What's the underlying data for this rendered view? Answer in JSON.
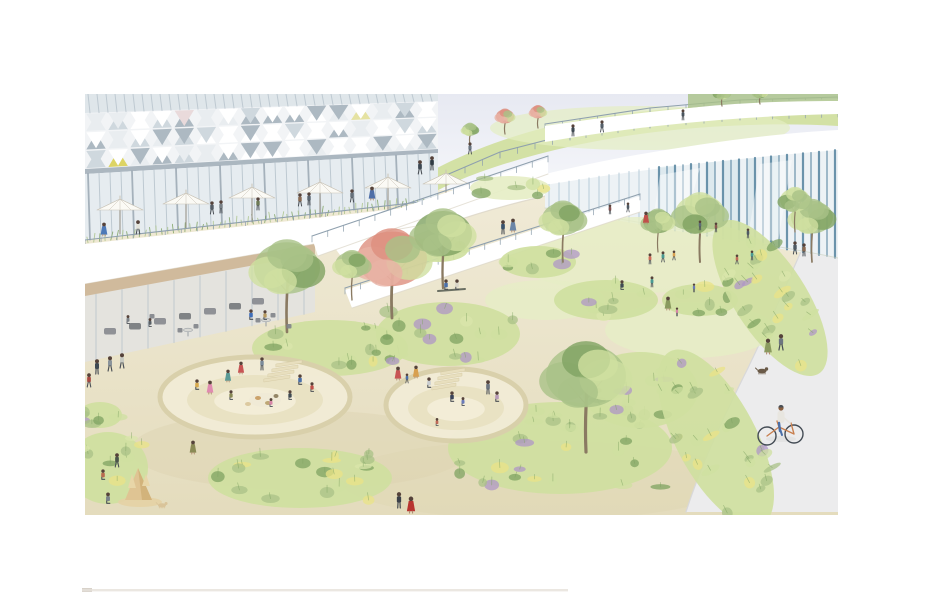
{
  "scene": {
    "type": "watercolor architectural perspective rendering",
    "subject": "landscaped plaza park with sunken seating pits, terraced buildings with green roofs, glass pavilions, planting beds and a promenade with a cyclist",
    "visible_text": "none",
    "artwork_bounds": {
      "x": 85,
      "y": 94,
      "width": 753,
      "height": 421
    }
  },
  "palette": {
    "paper": "#ffffff",
    "sky": "#e7e9f2",
    "skyFade": "#fafbfd",
    "ground": "#f0ead6",
    "groundDeep": "#e4dcbd",
    "groundShade": "#ddd3b0",
    "path": "#ececed",
    "pathEdge": "#d8d8da",
    "lawn": "#d9e5ab",
    "lawnLight": "#e6eec6",
    "hill": "#d3e1a5",
    "hillLight": "#e4eec2",
    "canopy": "#ffffff",
    "canopyShadow": "#dcd6c8",
    "glass": "#edf2f5",
    "glassTint": "#dfe6ea",
    "mullion": "#b7c3cc",
    "mullionDark": "#9aa7b2",
    "teal": "#5d89a3",
    "tealLight": "#b3c8d6",
    "tealPanel": "#cfe2e8",
    "triDark": "#adb9c2",
    "triMid": "#cfd8de",
    "triLight": "#e9edf0",
    "triYellow": "#ddd464",
    "triYellow2": "#e5e2a2",
    "triPink": "#e9dadb",
    "slab": "#ffffff",
    "wood": "#cdb391",
    "interior": "#e8e4da",
    "seat": "#80838a",
    "grassLight": "#cfe0a0",
    "grassMid": "#a9c287",
    "grassDark": "#7fa362",
    "accentYellow": "#e9e387",
    "accentPurple": "#af97c5",
    "blossom": "#dd8f7e",
    "blossomLight": "#e8b3a5",
    "trunk": "#8a7a62",
    "rail": "#8fa0ae",
    "pitFloor": "#f2ecd6",
    "pitInner": "#e8e0c0",
    "pitRim": "#d9d0ab",
    "sand": "#dfc493",
    "sandShade": "#c9a86a",
    "skin": "#b08b6e",
    "hair": "#55423a",
    "umbrella": "#fbfaf5",
    "umbrellaRib": "#c9c3b6",
    "pageLine": "#e6e1da"
  },
  "umbrellas": [
    {
      "x": 120,
      "y": 210
    },
    {
      "x": 186,
      "y": 204
    },
    {
      "x": 252,
      "y": 198
    },
    {
      "x": 320,
      "y": 193
    },
    {
      "x": 388,
      "y": 188
    },
    {
      "x": 446,
      "y": 184
    }
  ],
  "railings": [
    {
      "name": "hill-rail",
      "z": "back",
      "pts": [
        [
          430,
          182
        ],
        [
          500,
          152
        ],
        [
          570,
          134
        ],
        [
          650,
          122
        ],
        [
          740,
          114
        ],
        [
          838,
          111
        ]
      ],
      "post": 6
    },
    {
      "name": "roof-edge-rail",
      "z": "back",
      "pts": [
        [
          545,
          124
        ],
        [
          650,
          108
        ],
        [
          740,
          100
        ],
        [
          838,
          97
        ]
      ],
      "post": 4
    },
    {
      "name": "terrace-rail",
      "z": "mid",
      "pts": [
        [
          85,
          240
        ],
        [
          438,
          200
        ]
      ],
      "post": 5
    },
    {
      "name": "ramp-upper-rail",
      "z": "front",
      "pts": [
        [
          312,
          236
        ],
        [
          548,
          156
        ]
      ],
      "post": 6
    },
    {
      "name": "ramp-lower-rail",
      "z": "front",
      "pts": [
        [
          345,
          288
        ],
        [
          640,
          194
        ]
      ],
      "post": 6
    }
  ],
  "beds": [
    {
      "x": 330,
      "y": 348,
      "rx": 78,
      "ry": 28
    },
    {
      "x": 448,
      "y": 334,
      "rx": 72,
      "ry": 32,
      "pu": 1
    },
    {
      "x": 300,
      "y": 478,
      "rx": 92,
      "ry": 30,
      "ye": 1
    },
    {
      "x": 108,
      "y": 468,
      "rx": 40,
      "ry": 36,
      "ye": 1
    },
    {
      "x": 560,
      "y": 448,
      "rx": 112,
      "ry": 46,
      "ye": 1,
      "pu": 1
    },
    {
      "x": 640,
      "y": 390,
      "rx": 58,
      "ry": 38,
      "pu": 1
    },
    {
      "x": 606,
      "y": 300,
      "rx": 52,
      "ry": 20
    },
    {
      "x": 700,
      "y": 300,
      "rx": 38,
      "ry": 16
    },
    {
      "x": 538,
      "y": 262,
      "rx": 38,
      "ry": 16
    },
    {
      "x": 770,
      "y": 298,
      "rx": 36,
      "ry": 90,
      "rot": -33,
      "ye": 1,
      "pu": 1
    },
    {
      "x": 716,
      "y": 438,
      "rx": 40,
      "ry": 98,
      "rot": -28,
      "ye": 1,
      "pu": 1
    },
    {
      "x": 100,
      "y": 415,
      "rx": 22,
      "ry": 13
    },
    {
      "x": 438,
      "y": 250,
      "rx": 30,
      "ry": 12
    },
    {
      "x": 510,
      "y": 188,
      "rx": 40,
      "ry": 12,
      "light": 1
    }
  ],
  "lawnPatches": [
    {
      "x": 640,
      "y": 255,
      "rx": 130,
      "ry": 38
    },
    {
      "x": 545,
      "y": 300,
      "rx": 60,
      "ry": 20
    },
    {
      "x": 690,
      "y": 330,
      "rx": 85,
      "ry": 28
    }
  ],
  "trees": [
    {
      "x": 287,
      "y": 332,
      "h": 80,
      "r": 33,
      "t": "g"
    },
    {
      "x": 392,
      "y": 318,
      "h": 74,
      "r": 35,
      "t": "b"
    },
    {
      "x": 443,
      "y": 288,
      "h": 68,
      "r": 29,
      "t": "g"
    },
    {
      "x": 563,
      "y": 262,
      "h": 54,
      "r": 21,
      "t": "g"
    },
    {
      "x": 700,
      "y": 262,
      "h": 60,
      "r": 25,
      "t": "g"
    },
    {
      "x": 586,
      "y": 452,
      "h": 95,
      "r": 40,
      "t": "g"
    },
    {
      "x": 812,
      "y": 262,
      "h": 56,
      "r": 21,
      "t": "g"
    },
    {
      "x": 795,
      "y": 232,
      "h": 40,
      "r": 15,
      "t": "g"
    },
    {
      "x": 658,
      "y": 252,
      "h": 38,
      "r": 15,
      "t": "g"
    },
    {
      "x": 352,
      "y": 300,
      "h": 44,
      "r": 17,
      "t": "g"
    },
    {
      "x": 505,
      "y": 134,
      "h": 22,
      "r": 9,
      "t": "b"
    },
    {
      "x": 538,
      "y": 128,
      "h": 20,
      "r": 8,
      "t": "b"
    },
    {
      "x": 470,
      "y": 144,
      "h": 18,
      "r": 8,
      "t": "g"
    },
    {
      "x": 722,
      "y": 106,
      "h": 16,
      "r": 8,
      "t": "g"
    },
    {
      "x": 760,
      "y": 104,
      "h": 14,
      "r": 7,
      "t": "g"
    }
  ],
  "pits": [
    {
      "cx": 255,
      "cy": 397,
      "rx": 95,
      "ry": 40,
      "irx": 68,
      "iry": 25,
      "steps": {
        "x": 276,
        "y": 364,
        "n": 4,
        "w": 26,
        "dx": -4,
        "dy": 5
      }
    },
    {
      "cx": 456,
      "cy": 405,
      "rx": 70,
      "ry": 36,
      "irx": 48,
      "iry": 22,
      "steps": {
        "x": 441,
        "y": 372,
        "n": 4,
        "w": 24,
        "dx": -3,
        "dy": 5
      }
    }
  ],
  "picnic": [
    {
      "x": 265,
      "y": 400,
      "rx": 16,
      "ry": 7,
      "c": "#efe9d6"
    },
    {
      "x": 258,
      "y": 398,
      "rx": 3,
      "ry": 2,
      "c": "#c69a5e"
    },
    {
      "x": 268,
      "y": 403,
      "rx": 3,
      "ry": 2,
      "c": "#b8a06a"
    },
    {
      "x": 276,
      "y": 396,
      "rx": 2.5,
      "ry": 2,
      "c": "#8a7a5a"
    },
    {
      "x": 248,
      "y": 404,
      "rx": 3,
      "ry": 2,
      "c": "#d9c49a"
    }
  ],
  "sandcastle": {
    "x": 138,
    "y": 500
  },
  "furniture": {
    "tables": [
      {
        "x": 266,
        "y": 320
      },
      {
        "x": 188,
        "y": 330
      }
    ],
    "chairs": [
      {
        "x": 258,
        "y": 322
      },
      {
        "x": 273,
        "y": 317
      },
      {
        "x": 289,
        "y": 328
      },
      {
        "x": 180,
        "y": 332
      },
      {
        "x": 196,
        "y": 328
      },
      {
        "x": 152,
        "y": 318
      }
    ],
    "bench": {
      "x1": 438,
      "y1": 291,
      "x2": 465,
      "y2": 289
    },
    "interiorSeats": [
      {
        "x": 110,
        "y": 332
      },
      {
        "x": 135,
        "y": 327
      },
      {
        "x": 160,
        "y": 322
      },
      {
        "x": 185,
        "y": 317
      },
      {
        "x": 210,
        "y": 312
      },
      {
        "x": 235,
        "y": 307
      },
      {
        "x": 258,
        "y": 302
      }
    ]
  },
  "people": [
    {
      "x": 104,
      "y": 236,
      "h": 13,
      "c": "#4d79b8",
      "d": 1
    },
    {
      "x": 138,
      "y": 234,
      "h": 13,
      "c": "#e3e3da"
    },
    {
      "x": 212,
      "y": 214,
      "h": 12,
      "c": "#555d66"
    },
    {
      "x": 221,
      "y": 213,
      "h": 12,
      "c": "#7a8288"
    },
    {
      "x": 258,
      "y": 210,
      "h": 12,
      "c": "#6d7a55"
    },
    {
      "x": 300,
      "y": 206,
      "h": 12,
      "c": "#8a6a52"
    },
    {
      "x": 309,
      "y": 205,
      "h": 12,
      "c": "#5a6570"
    },
    {
      "x": 352,
      "y": 202,
      "h": 12,
      "c": "#66707a"
    },
    {
      "x": 573,
      "y": 136,
      "h": 11,
      "c": "#3f4a52"
    },
    {
      "x": 602,
      "y": 132,
      "h": 11,
      "c": "#55606a"
    },
    {
      "x": 683,
      "y": 120,
      "h": 10,
      "c": "#4a555e"
    },
    {
      "x": 470,
      "y": 154,
      "h": 11,
      "c": "#6a7580"
    },
    {
      "x": 420,
      "y": 174,
      "h": 13,
      "c": "#3d4852"
    },
    {
      "x": 432,
      "y": 170,
      "h": 13,
      "c": "#2f3a44"
    },
    {
      "x": 372,
      "y": 200,
      "h": 13,
      "c": "#4f6fa8",
      "d": 1
    },
    {
      "x": 503,
      "y": 234,
      "h": 13,
      "c": "#39536e"
    },
    {
      "x": 513,
      "y": 232,
      "h": 13,
      "c": "#6b86a8",
      "d": 1
    },
    {
      "x": 610,
      "y": 214,
      "h": 9,
      "c": "#84504e"
    },
    {
      "x": 628,
      "y": 212,
      "h": 9,
      "c": "#4f5a64"
    },
    {
      "x": 700,
      "y": 230,
      "h": 9,
      "c": "#5d6a74"
    },
    {
      "x": 716,
      "y": 232,
      "h": 9,
      "c": "#8a5a50"
    },
    {
      "x": 748,
      "y": 238,
      "h": 9,
      "c": "#4f5a64"
    },
    {
      "x": 646,
      "y": 224,
      "h": 12,
      "c": "#c0504a",
      "d": 1
    },
    {
      "x": 650,
      "y": 264,
      "h": 10,
      "c": "#cf6a58"
    },
    {
      "x": 663,
      "y": 262,
      "h": 10,
      "c": "#4a9a94"
    },
    {
      "x": 674,
      "y": 260,
      "h": 9,
      "c": "#d8a050"
    },
    {
      "x": 622,
      "y": 290,
      "h": 11,
      "c": "#3f4a52",
      "p": 1
    },
    {
      "x": 652,
      "y": 287,
      "h": 10,
      "c": "#4a9a94"
    },
    {
      "x": 668,
      "y": 310,
      "h": 13,
      "c": "#8a9a5f",
      "d": 1
    },
    {
      "x": 677,
      "y": 316,
      "h": 8,
      "c": "#d885a8"
    },
    {
      "x": 694,
      "y": 292,
      "h": 8,
      "c": "#6a7ab8"
    },
    {
      "x": 446,
      "y": 290,
      "h": 12,
      "c": "#4a6fa8",
      "p": 1
    },
    {
      "x": 457,
      "y": 290,
      "h": 12,
      "c": "#d8d4c8",
      "p": 1
    },
    {
      "x": 251,
      "y": 320,
      "h": 12,
      "c": "#3f6db8",
      "p": 1
    },
    {
      "x": 265,
      "y": 320,
      "h": 11,
      "c": "#b89a60",
      "p": 1
    },
    {
      "x": 150,
      "y": 327,
      "h": 10,
      "c": "#596066",
      "p": 1
    },
    {
      "x": 128,
      "y": 324,
      "h": 10,
      "c": "#7b8187",
      "p": 1
    },
    {
      "x": 97,
      "y": 374,
      "h": 14,
      "c": "#3f4a52"
    },
    {
      "x": 110,
      "y": 371,
      "h": 14,
      "c": "#8a939b"
    },
    {
      "x": 122,
      "y": 368,
      "h": 14,
      "c": "#c8cac2"
    },
    {
      "x": 89,
      "y": 387,
      "h": 13,
      "c": "#a84a42"
    },
    {
      "x": 210,
      "y": 394,
      "h": 13,
      "c": "#e08bb0",
      "d": 1
    },
    {
      "x": 197,
      "y": 390,
      "h": 12,
      "c": "#d7a94e",
      "p": 1
    },
    {
      "x": 228,
      "y": 382,
      "h": 12,
      "c": "#5a9a96",
      "d": 1
    },
    {
      "x": 241,
      "y": 374,
      "h": 12,
      "c": "#c85454",
      "d": 1
    },
    {
      "x": 262,
      "y": 370,
      "h": 12,
      "c": "#7a8a9a"
    },
    {
      "x": 300,
      "y": 385,
      "h": 12,
      "c": "#4a6fa8",
      "p": 1
    },
    {
      "x": 312,
      "y": 392,
      "h": 11,
      "c": "#c0504a",
      "p": 1
    },
    {
      "x": 290,
      "y": 400,
      "h": 11,
      "c": "#3f4a52",
      "p": 1
    },
    {
      "x": 271,
      "y": 407,
      "h": 10,
      "c": "#d885a8",
      "p": 1
    },
    {
      "x": 231,
      "y": 400,
      "h": 11,
      "c": "#8a8a55",
      "p": 1
    },
    {
      "x": 193,
      "y": 454,
      "h": 13,
      "c": "#8a8a55",
      "d": 1
    },
    {
      "x": 117,
      "y": 467,
      "h": 13,
      "c": "#4a554a"
    },
    {
      "x": 103,
      "y": 480,
      "h": 12,
      "c": "#b86a50",
      "p": 1
    },
    {
      "x": 108,
      "y": 504,
      "h": 13,
      "c": "#7a8288",
      "p": 1
    },
    {
      "x": 398,
      "y": 380,
      "h": 13,
      "c": "#c85454",
      "d": 1
    },
    {
      "x": 407,
      "y": 383,
      "h": 9,
      "c": "#4a6fa8"
    },
    {
      "x": 416,
      "y": 378,
      "h": 12,
      "c": "#d8a050",
      "d": 1
    },
    {
      "x": 429,
      "y": 388,
      "h": 12,
      "c": "#c8ccd0",
      "p": 1
    },
    {
      "x": 452,
      "y": 402,
      "h": 12,
      "c": "#39435a",
      "p": 1
    },
    {
      "x": 463,
      "y": 406,
      "h": 10,
      "c": "#6a7ab8",
      "p": 1
    },
    {
      "x": 488,
      "y": 394,
      "h": 13,
      "c": "#6d7580"
    },
    {
      "x": 497,
      "y": 402,
      "h": 12,
      "c": "#b89ab8",
      "p": 1
    },
    {
      "x": 437,
      "y": 426,
      "h": 9,
      "c": "#c06a58",
      "p": 1
    },
    {
      "x": 399,
      "y": 508,
      "h": 15,
      "c": "#3a3f47"
    },
    {
      "x": 411,
      "y": 513,
      "h": 16,
      "c": "#b8352f",
      "d": 1
    },
    {
      "x": 768,
      "y": 354,
      "h": 15,
      "c": "#8a9a5f",
      "d": 1
    },
    {
      "x": 781,
      "y": 350,
      "h": 15,
      "c": "#6d7580"
    },
    {
      "x": 795,
      "y": 254,
      "h": 12,
      "c": "#4f5a64"
    },
    {
      "x": 804,
      "y": 256,
      "h": 12,
      "c": "#8a6a52"
    },
    {
      "x": 737,
      "y": 264,
      "h": 9,
      "c": "#c06a58"
    },
    {
      "x": 752,
      "y": 260,
      "h": 9,
      "c": "#4a9a94"
    }
  ],
  "cyclist": {
    "x": 781,
    "y": 437
  },
  "dogs": [
    {
      "x": 762,
      "y": 374,
      "c": "#6a5a48",
      "s": 1
    },
    {
      "x": 162,
      "y": 508,
      "c": "#d9c49a",
      "s": 0.9
    }
  ],
  "pageLine": {
    "x": 82,
    "y": 589,
    "width": 486
  }
}
